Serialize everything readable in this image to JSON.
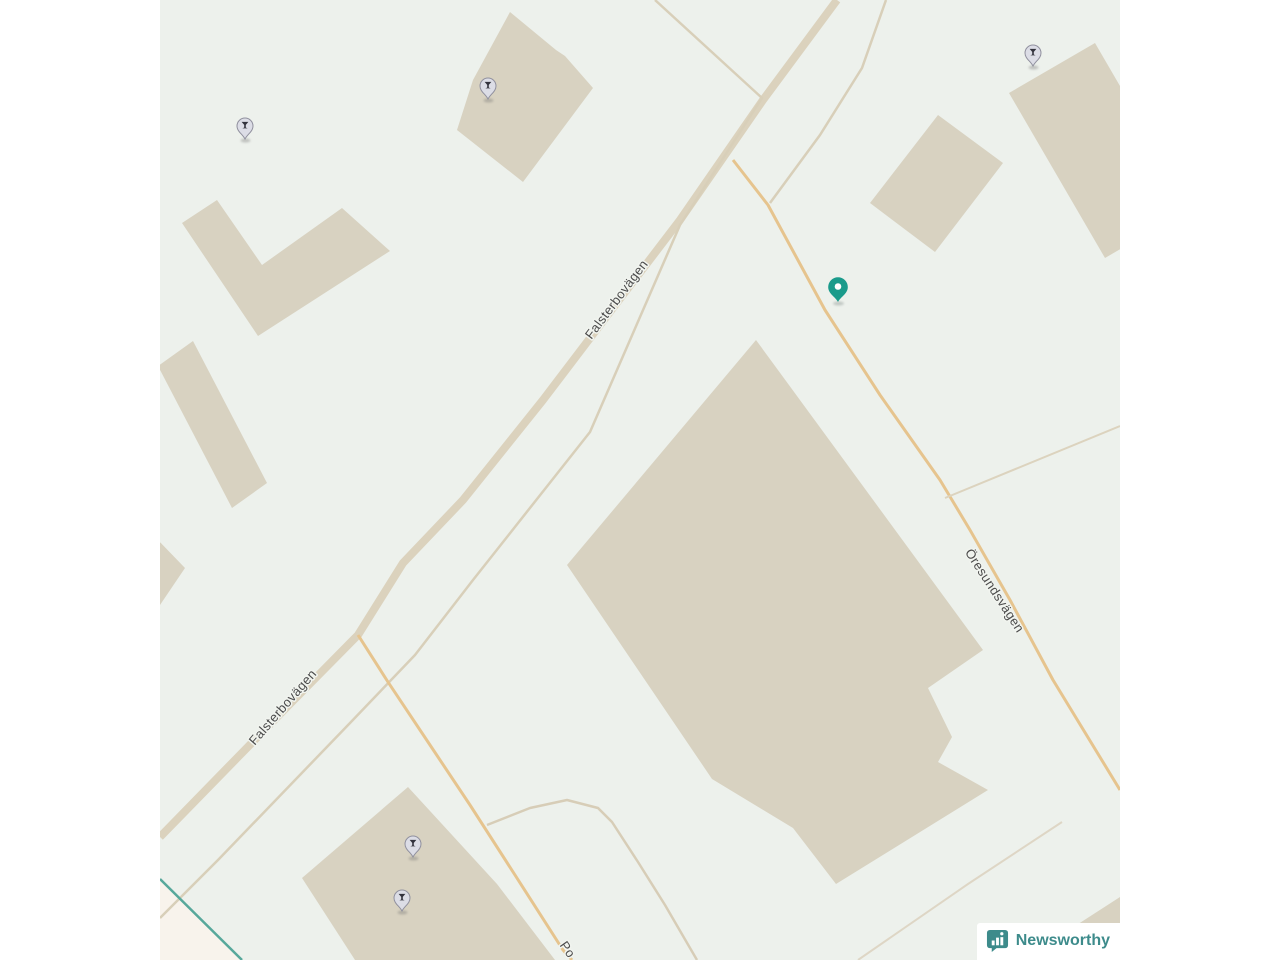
{
  "map": {
    "background_color": "#edf1ec",
    "building_fill": "#d8d2c1",
    "land_patch_fill": "#f8f3ec",
    "road_label_color": "#4b4b4b",
    "buildings": [
      {
        "id": "building-top-center",
        "points": "350,12 396,50 405,56 433,88 363,182 297,130 313,80"
      },
      {
        "id": "building-l-shape-northwest",
        "points": "22,223 57,200 102,265 182,208 230,251 98,336"
      },
      {
        "id": "building-thin-west",
        "points": "33,341 107,483 72,508 -2,366"
      },
      {
        "id": "building-sliver-west-edge",
        "points": "-2,540 25,568 -2,608"
      },
      {
        "id": "building-square-northeast",
        "points": "710,203 778,115 843,163 775,252"
      },
      {
        "id": "building-tall-east-edge",
        "points": "849,93 935,43 1031,208 945,258"
      },
      {
        "id": "building-large-central",
        "points": "596,340 823,650 768,688 792,737 778,762 828,790 676,884 633,828 552,779 407,565"
      },
      {
        "id": "building-bottom-south",
        "points": "248,787 337,884 395,960 195,960 142,878"
      },
      {
        "id": "building-corner-southeast",
        "points": "912,928 960,897 960,960 877,960"
      }
    ],
    "areas": [
      {
        "id": "land-patch-southwest",
        "points": "0,879 82,960 0,960",
        "fill": "#f8f3ec"
      }
    ],
    "roads": [
      {
        "id": "road-falsterbovagen-main",
        "points": "677,0 603,100 520,220 459,300 383,400 303,500 243,563 198,635 125,709 78,757 0,837",
        "color": "#dbd2bd",
        "width": 8
      },
      {
        "id": "road-parallel-service",
        "points": "495,0 602,98 520,225 430,432 313,580 255,655 190,723 58,860 0,918",
        "color": "#d8cfb9",
        "width": 2.5
      },
      {
        "id": "road-northeast-feeder",
        "points": "726,0 702,68 660,135 610,203",
        "color": "#d8cfb9",
        "width": 2.5
      },
      {
        "id": "road-oresundsvagen",
        "points": "573,160 608,205 665,310 720,395 780,480 810,530 850,600 893,680 960,790",
        "color": "#e6c48e",
        "width": 3
      },
      {
        "id": "road-south-branch",
        "points": "198,635 228,682 270,745 310,805 355,875 403,950 412,960",
        "color": "#e6c48e",
        "width": 3
      },
      {
        "id": "road-east-stub",
        "points": "785,498 960,426",
        "color": "#dcd3be",
        "width": 2
      },
      {
        "id": "path-curved-south",
        "points": "327,825 370,808 407,800 438,808 452,822 478,862 505,905 530,948 537,960",
        "color": "#d7cdb7",
        "width": 2.5
      },
      {
        "id": "path-faint-southeast",
        "points": "902,822 808,884 698,960",
        "color": "#ded6c5",
        "width": 2
      },
      {
        "id": "boundary-teal-southwest",
        "points": "0,879 82,960",
        "color": "#57a89b",
        "width": 2.5
      }
    ],
    "street_labels": [
      {
        "text": "Falsterbovägen",
        "x": 460,
        "y": 302,
        "rotate": -53
      },
      {
        "text": "Falsterbovägen",
        "x": 126,
        "y": 710,
        "rotate": -49
      },
      {
        "text": "Öresundsvägen",
        "x": 831,
        "y": 593,
        "rotate": 57
      },
      {
        "text": "Po",
        "x": 404,
        "y": 952,
        "rotate": 55
      }
    ],
    "poi_markers": [
      {
        "type": "bar",
        "x": 85,
        "y": 126
      },
      {
        "type": "bar",
        "x": 328,
        "y": 86
      },
      {
        "type": "bar",
        "x": 873,
        "y": 53
      },
      {
        "type": "bar",
        "x": 253,
        "y": 844
      },
      {
        "type": "bar",
        "x": 242,
        "y": 898
      }
    ],
    "poi_style": {
      "fill": "#dcdde6",
      "stroke": "#90909e",
      "glyph_color": "#33333d"
    },
    "location_pin": {
      "x": 678,
      "y": 287,
      "color": "#1a9b8b",
      "hole_color": "#ffffff"
    }
  },
  "attribution": {
    "brand": "Newsworthy",
    "brand_color": "#3d8b8b"
  }
}
